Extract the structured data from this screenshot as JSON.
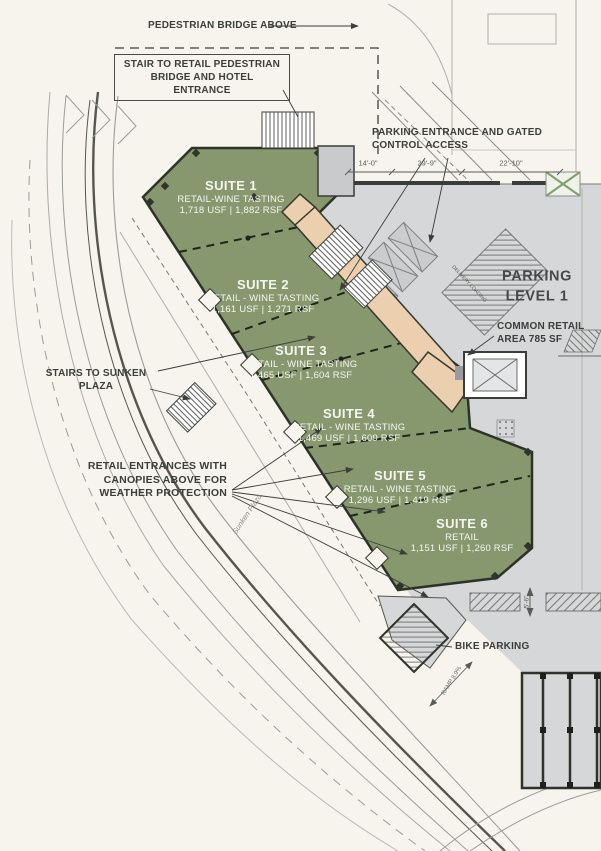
{
  "labels": {
    "pedestrian_bridge_above": "PEDESTRIAN BRIDGE ABOVE",
    "stair_to_retail": "STAIR TO RETAIL PEDESTRIAN BRIDGE AND HOTEL ENTRANCE",
    "parking_entrance": "PARKING ENTRANCE AND GATED CONTROL ACCESS",
    "parking_level_line1": "PARKING",
    "parking_level_line2": "LEVEL 1",
    "common_retail": "COMMON RETAIL AREA 785 SF",
    "stairs_to_sunken_plaza": "STAIRS TO SUNKEN PLAZA",
    "retail_entrances": "RETAIL ENTRANCES WITH CANOPIES ABOVE FOR WEATHER PROTECTION",
    "bike_parking": "BIKE PARKING",
    "ramp": "RAMP 8.9%",
    "sunken_plaza": "Sunken Plaza",
    "delivery_loading": "DELIVERY LOADING"
  },
  "dimensions": {
    "d1": "14'-0\"",
    "d2": "29'-9\"",
    "d3": "22'-10\"",
    "d4": "5'-6\""
  },
  "suites": [
    {
      "name": "SUITE 1",
      "use": "RETAIL-WINE TASTING",
      "area": "1,718 USF | 1,882 RSF"
    },
    {
      "name": "SUITE 2",
      "use": "RETAIL - WINE TASTING",
      "area": "1,161 USF | 1,271 RSF"
    },
    {
      "name": "SUITE 3",
      "use": "RETAIL - WINE TASTING",
      "area": "1,465 USF | 1,604 RSF"
    },
    {
      "name": "SUITE 4",
      "use": "RETAIL - WINE TASTING",
      "area": "1,469 USF | 1,609 RSF"
    },
    {
      "name": "SUITE 5",
      "use": "RETAIL - WINE TASTING",
      "area": "1,296 USF | 1,419 RSF"
    },
    {
      "name": "SUITE 6",
      "use": "RETAIL",
      "area": "1,151 USF | 1,260 RSF"
    }
  ],
  "colors": {
    "suite_fill": "#87986f",
    "corridor_fill": "#ebcfae",
    "parking_fill": "#d6d7d9",
    "background": "#f7f4ee",
    "line": "#3a3d38"
  }
}
